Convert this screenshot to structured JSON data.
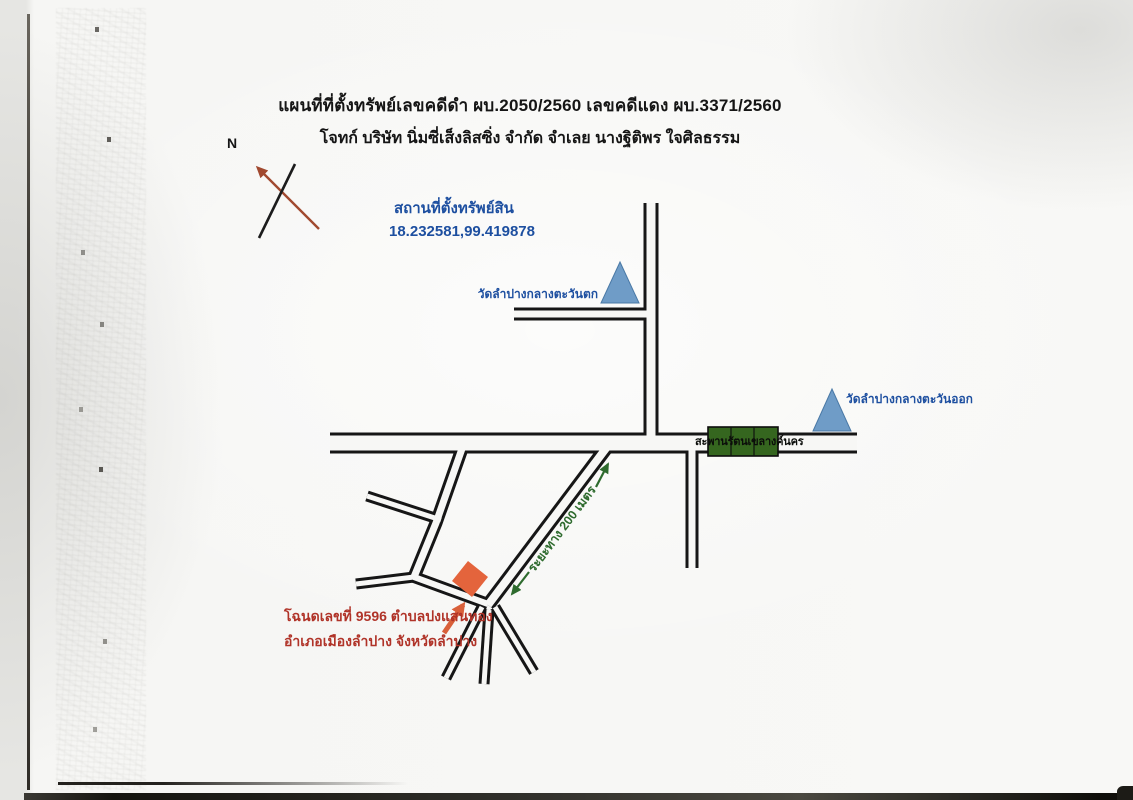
{
  "document": {
    "title_line1": "แผนที่ที่ตั้งทรัพย์เลขคดีดำ ผบ.2050/2560 เลขคดีแดง ผบ.3371/2560",
    "title_line2": "โจทก์ บริษัท นิ่มซี่เส็งลิสซิ่ง จำกัด   จำเลย นางฐิติพร ใจศิลธรรม"
  },
  "compass": {
    "north_label": "N"
  },
  "location": {
    "label": "สถานที่ตั้งทรัพย์สิน",
    "coordinates": "18.232581,99.419878"
  },
  "landmarks": {
    "temple_west": "วัดลำปางกลางตะวันตก",
    "temple_east": "วัดลำปางกลางตะวันออก",
    "bridge": "สะพานรัตนเขลางค์นคร"
  },
  "property": {
    "deed_line1": "โฉนดเลขที่ 9596 ตำบลปงแสนทอง",
    "deed_line2": "อำเภอเมืองลำปาง จังหวัดลำปาง",
    "distance_label": "ระยะทาง  200 เมตร"
  },
  "colors": {
    "road": "#161616",
    "road_fill": "#f7f7f5",
    "temple_marker": "#6f9cc7",
    "bridge_marker": "#35661f",
    "property_marker": "#e4643c",
    "property_arrow": "#d9603a",
    "distance_accent": "#2e6b2e",
    "north_arrow": "#a1492f",
    "deed_text": "#b03328",
    "location_text": "#1d4fa0"
  }
}
